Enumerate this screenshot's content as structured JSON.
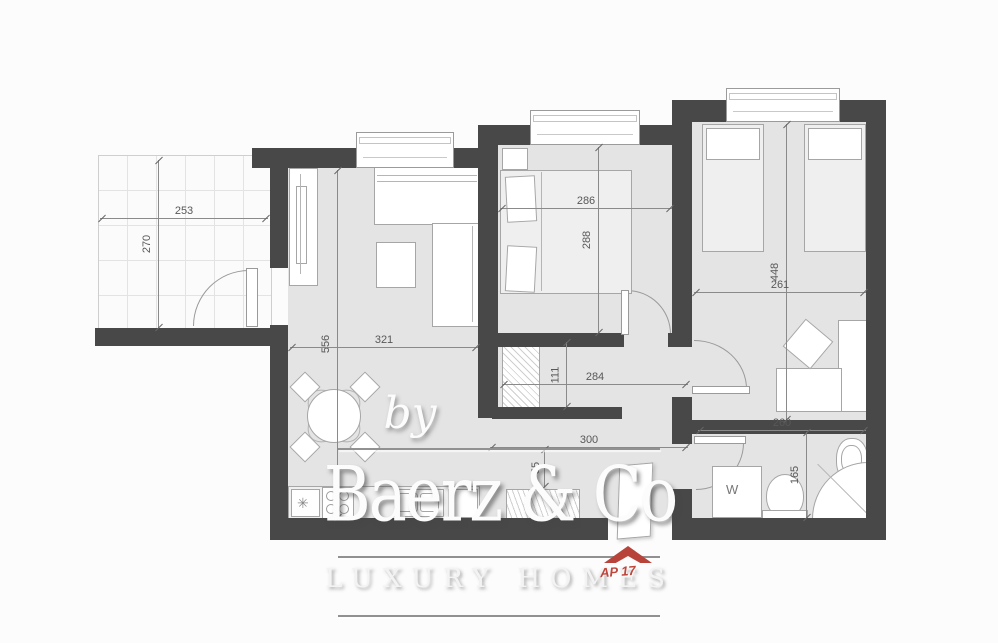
{
  "watermark": {
    "prefix": "by",
    "brand": "Baerz & Co",
    "tagline": "LUXURY HOMES",
    "unit": "AP 17"
  },
  "plan": {
    "dimensions": {
      "terrace_width": "253",
      "terrace_depth": "270",
      "living_length": "556",
      "living_width": "321",
      "bedroom1_width": "286",
      "bedroom1_length": "288",
      "bedroom2_length": "448",
      "bedroom2_width": "261",
      "hall_niche_depth": "111",
      "hall_niche_width": "284",
      "hall_width": "300",
      "hall_cabinet_depth": "55",
      "bathroom_width": "260",
      "bathroom_depth": "165"
    },
    "labels": {
      "washing_machine": "W",
      "hob": "✳"
    },
    "colors": {
      "wall": "#484848",
      "floor": "#e4e4e4",
      "accent_red": "#b8433a"
    }
  }
}
